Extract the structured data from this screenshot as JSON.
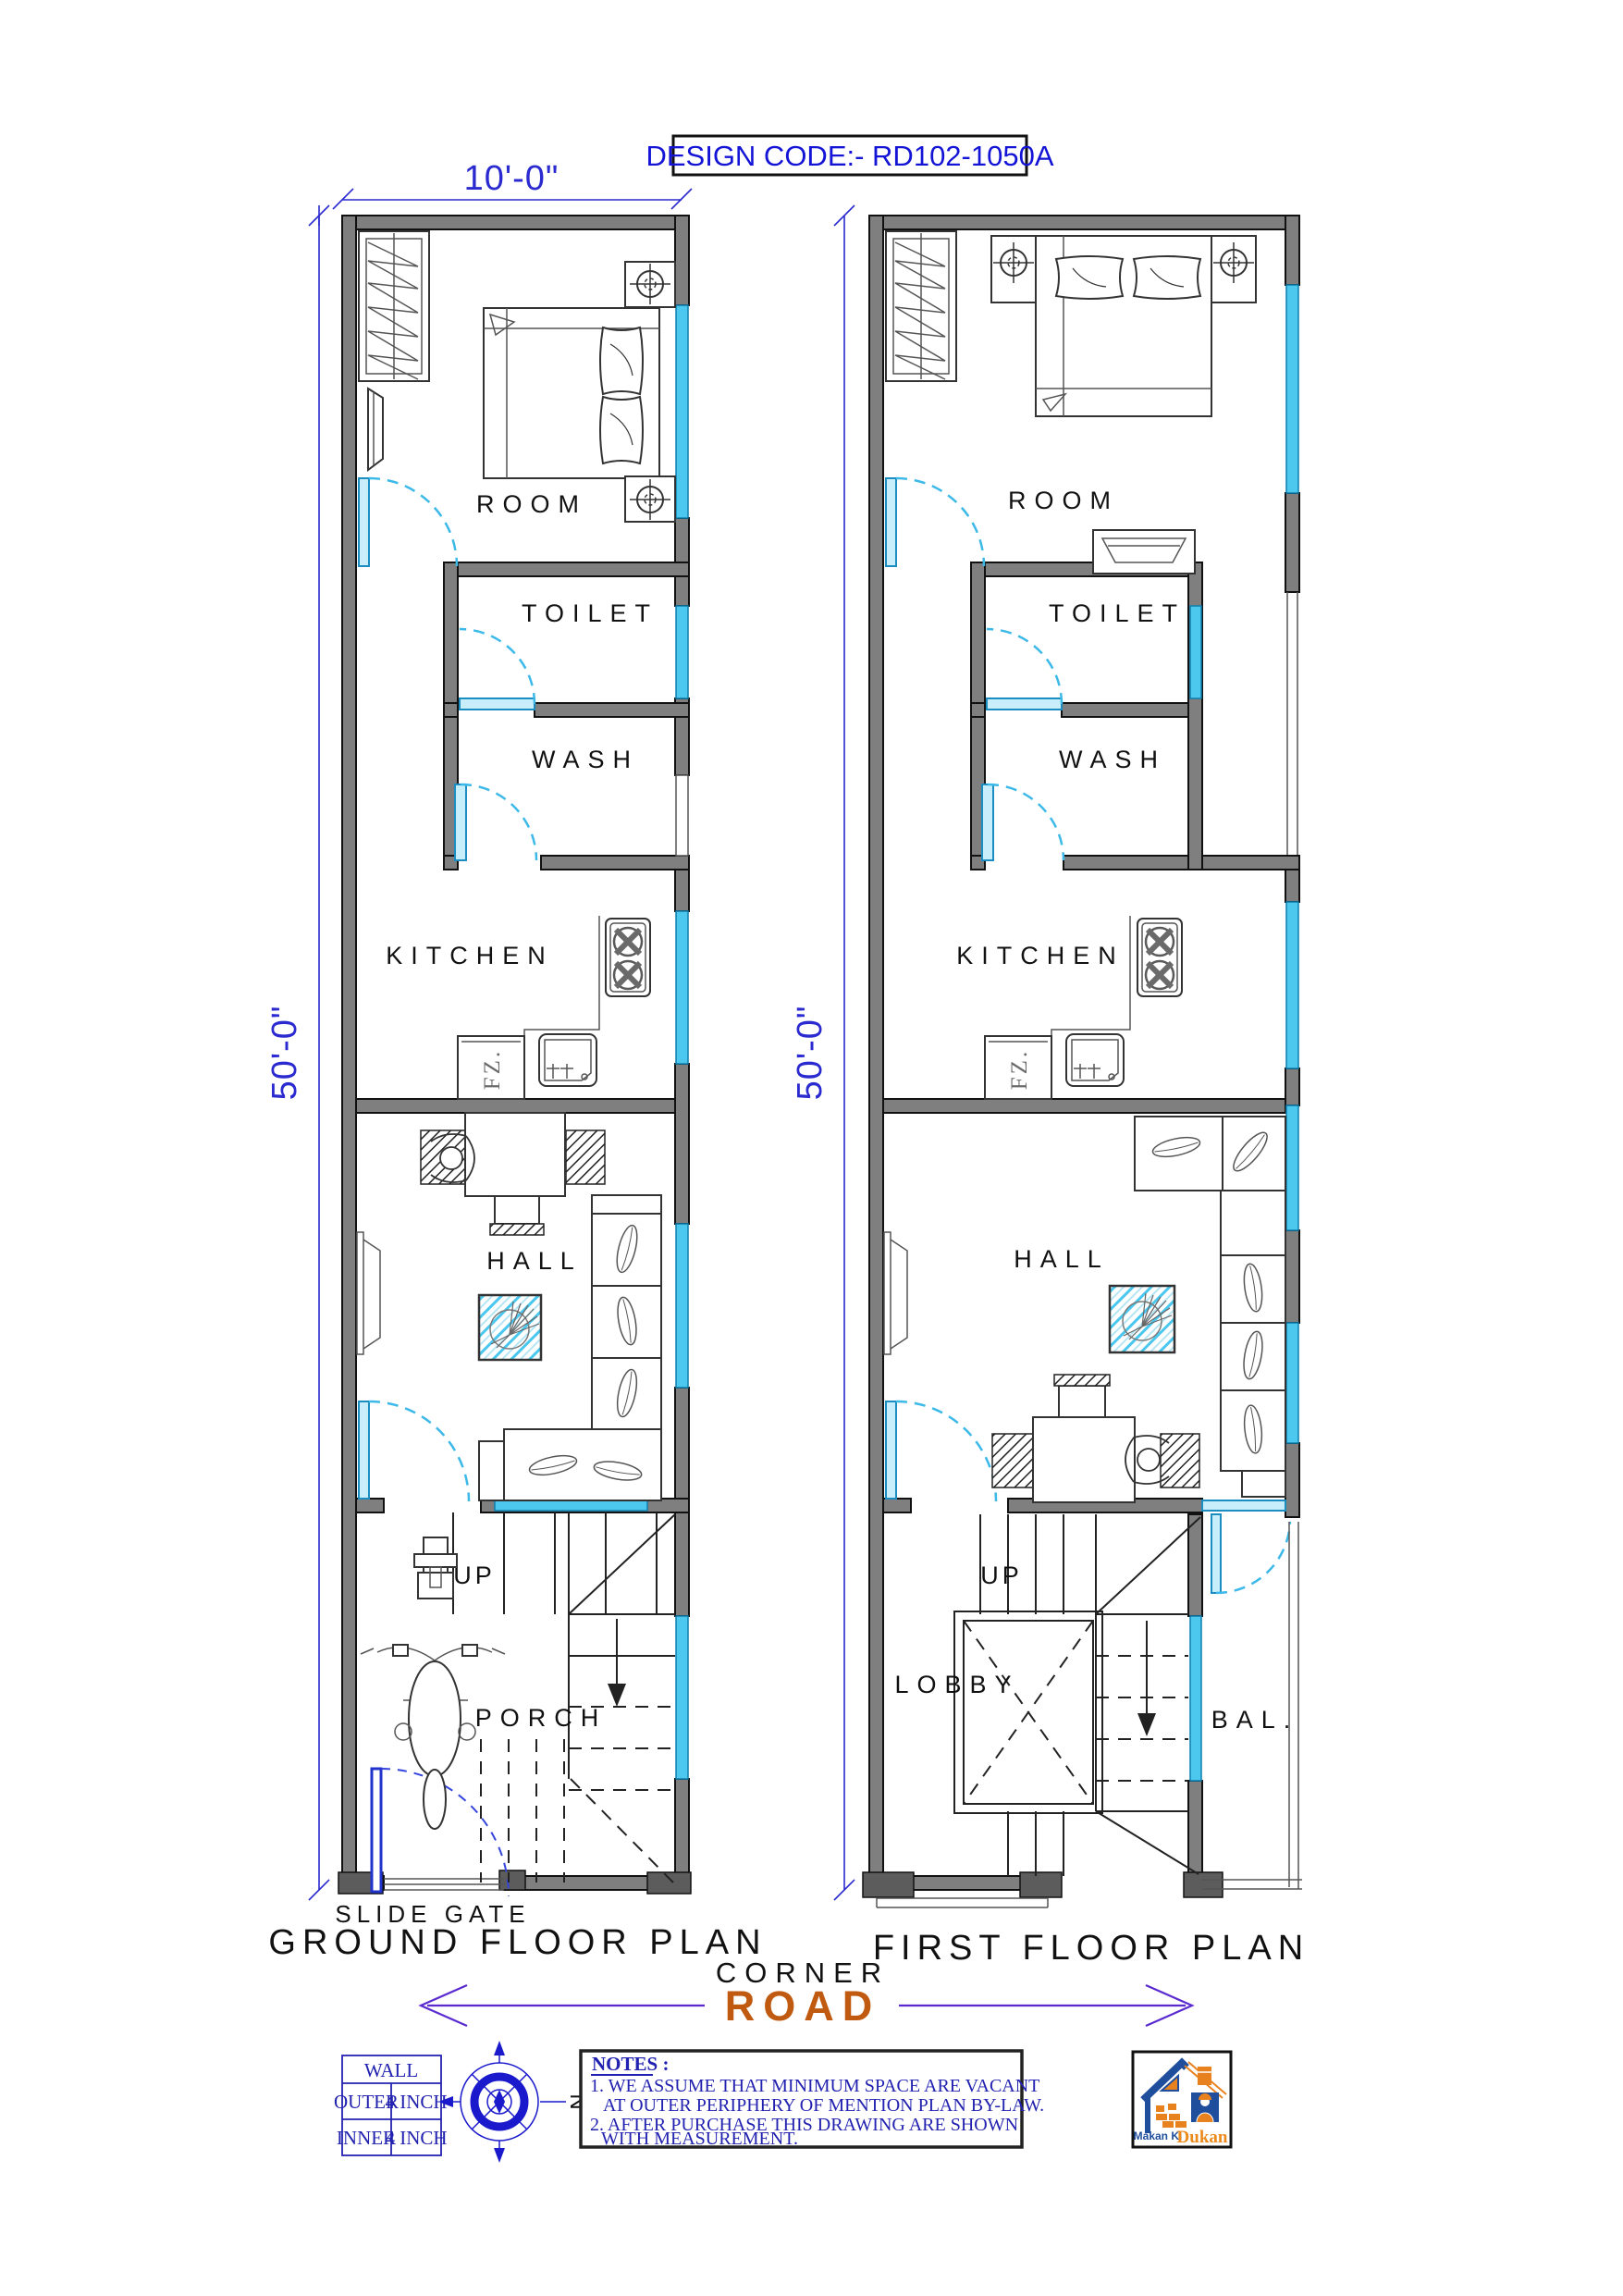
{
  "design_code": {
    "label": "DESIGN CODE:- RD102-1050A"
  },
  "dimensions": {
    "plot_width": "10'-0\"",
    "ground_height": "50'-0\"",
    "first_height": "50'-0\""
  },
  "ground_floor": {
    "title": "GROUND FLOOR PLAN",
    "gate_label": "SLIDE GATE",
    "room": "ROOM",
    "toilet": "TOILET",
    "wash": "WASH",
    "kitchen": "KITCHEN",
    "hall": "HALL",
    "porch": "PORCH",
    "stairs_up": "UP",
    "freezer": "FZ."
  },
  "first_floor": {
    "title": "FIRST FLOOR PLAN",
    "room": "ROOM",
    "toilet": "TOILET",
    "wash": "WASH",
    "kitchen": "KITCHEN",
    "hall": "HALL",
    "lobby": "LOBBY",
    "balcony": "BAL.",
    "stairs_up": "UP",
    "freezer": "FZ."
  },
  "road": {
    "corner_label": "CORNER",
    "road_label": "ROAD"
  },
  "wall_legend": {
    "header": "WALL",
    "rows": [
      {
        "type": "OUTER",
        "size": "4 INCH"
      },
      {
        "type": "INNER",
        "size": "4 INCH"
      }
    ]
  },
  "compass": {
    "north": "N"
  },
  "notes": {
    "heading": "NOTES :",
    "line1": "1. WE ASSUME THAT MINIMUM SPACE ARE VACANT",
    "line2": "AT OUTER PERIPHERY OF MENTION PLAN BY-LAW.",
    "line3": "2. AFTER PURCHASE THIS DRAWING ARE SHOWN",
    "line4": "WITH  MEASUREMENT."
  },
  "logo": {
    "name_top": "Makan Ki",
    "name_bottom": "Dukan"
  },
  "colors": {
    "wall_fill": "#7f7f7f",
    "window_glass": "#4cc7ee",
    "door_swing": "#3cb9e8",
    "dimension_blue": "#2a2ad0",
    "design_code_blue": "#1414d6",
    "notes_blue": "#2222b0",
    "road_orange": "#c05a10",
    "road_arrow_purple": "#5a2ad0",
    "slide_gate_blue": "#2233cc",
    "logo_blue": "#1f4e9c",
    "logo_orange": "#ec8a1c"
  }
}
